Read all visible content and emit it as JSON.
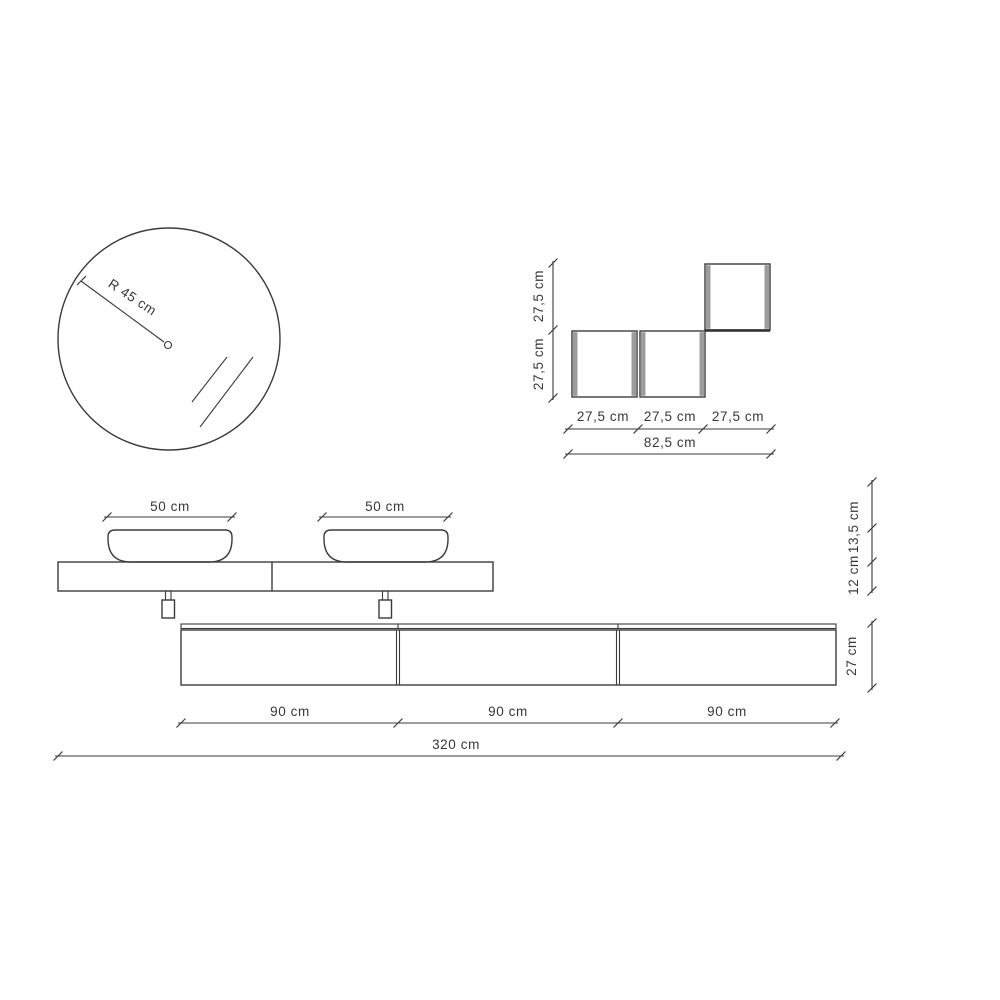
{
  "drawing_title": "bathroom-vanity-dimension-drawing",
  "units": "cm",
  "mirror": {
    "radius_label": "R 45 cm"
  },
  "wall_cabinets": {
    "height_labels": [
      "27,5 cm",
      "27,5 cm"
    ],
    "width_labels": [
      "27,5 cm",
      "27,5 cm",
      "27,5 cm"
    ],
    "total_width_label": "82,5 cm"
  },
  "vanity": {
    "basin_width_labels": [
      "50 cm",
      "50 cm"
    ],
    "basin_height_label": "13,5 cm",
    "counter_thickness_label": "12 cm"
  },
  "base_cabinet": {
    "module_width_labels": [
      "90 cm",
      "90 cm",
      "90 cm"
    ],
    "height_label": "27 cm"
  },
  "overall": {
    "total_width_label": "320 cm"
  },
  "colors": {
    "line": "#3b3b3b",
    "text": "#383838",
    "cabinet_side_gray": "#9c9c9c",
    "background": "#ffffff"
  }
}
